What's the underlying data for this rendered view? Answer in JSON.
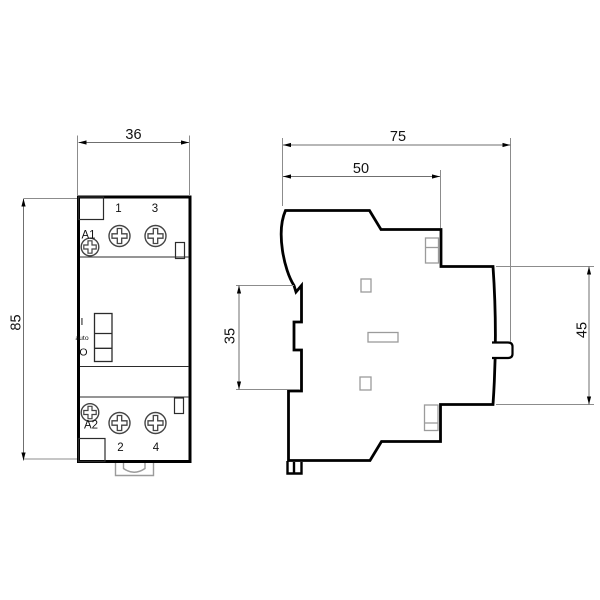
{
  "drawing": {
    "type": "technical-dimension-drawing",
    "subject": "modular-contactor-front-and-side-views",
    "views": {
      "front": {
        "dim_width": "36",
        "dim_height": "85",
        "terminal_top_left": "1",
        "terminal_top_right": "3",
        "terminal_bottom_left": "2",
        "terminal_bottom_right": "4",
        "coil_top": "A1",
        "coil_bottom": "A2",
        "switch_on": "I",
        "switch_auto": "auto",
        "switch_off": "O"
      },
      "side": {
        "dim_depth": "75",
        "dim_front_depth": "50",
        "dim_right_height": "45",
        "dim_rail_height": "35"
      }
    },
    "colors": {
      "outline": "#000000",
      "detail_dark": "#2b2b2b",
      "detail_gray": "#9b9b9b",
      "dim_line": "#6f6f6f",
      "ext_line": "#8c8c8c",
      "screw_stroke": "#444444",
      "background": "#ffffff"
    }
  }
}
